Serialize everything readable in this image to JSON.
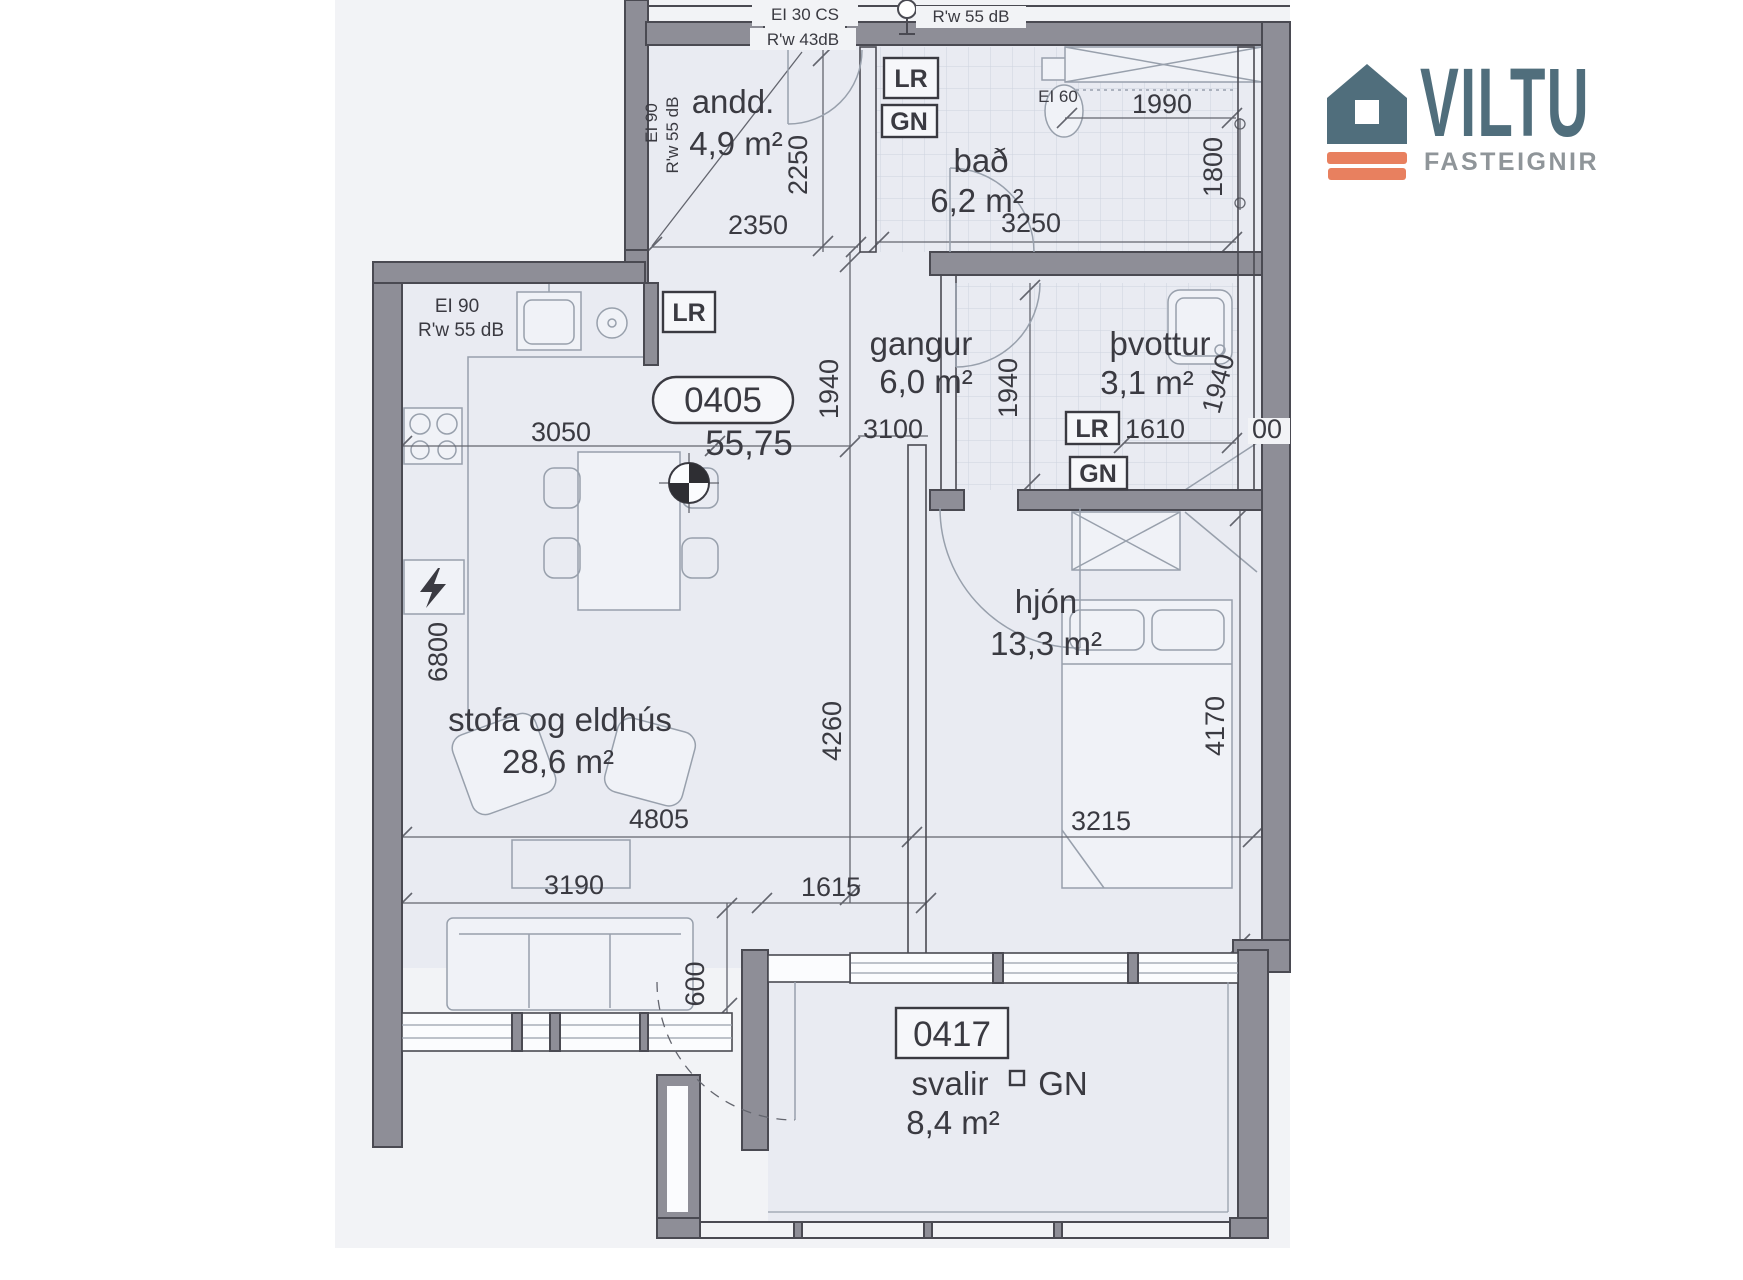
{
  "theme": {
    "ink": "#3a3a41",
    "wall": "#8e8e97",
    "wallstroke": "#4a4a52",
    "line": "#63656e",
    "furn": "#98a0ac",
    "paper": "#e9ebf2",
    "scan": "#f2f3f6",
    "tile": "#cdd3df",
    "slate": "#506e7c",
    "orange": "#e8805f",
    "graytag": "#8f9599"
  },
  "logo": {
    "brand": "VILTU",
    "tagline": "FASTEIGNIR"
  },
  "plan": {
    "unit": {
      "number": "0405",
      "total_area": "55,75"
    },
    "balcony_unit": {
      "number": "0417"
    },
    "tags": {
      "lr": "LR",
      "gn": "GN"
    },
    "rooms": {
      "andd": {
        "name": "andd.",
        "area": "4,9 m²"
      },
      "bad": {
        "name": "bað",
        "area": "6,2 m²"
      },
      "gangur": {
        "name": "gangur",
        "area": "6,0 m²"
      },
      "thvottur": {
        "name": "þvottur",
        "area": "3,1 m²"
      },
      "hjon": {
        "name": "hjón",
        "area": "13,3 m²"
      },
      "stofa": {
        "name": "stofa og eldhús",
        "area": "28,6 m²"
      },
      "svalir": {
        "name": "svalir",
        "area": "8,4 m²"
      }
    },
    "fire_sound": {
      "top_cs": "EI 30 CS",
      "top_rw": "R'w 55 dB",
      "entry_rw": "R'w 43dB",
      "andd_ei": "EI 90",
      "andd_rw": "R'w 55 dB",
      "kitchen_ei": "EI 90",
      "kitchen_rw": "R'w 55 dB",
      "bath_ei": "EI 60"
    },
    "dimensions": {
      "andd_w": "2350",
      "andd_h": "2250",
      "bath_w": "3250",
      "bath_top": "1990",
      "bath_depth": "1800",
      "kitchen_w": "3050",
      "hall_w": "3100",
      "hall_h": "1940",
      "laundry_h": "1940",
      "laundry_right": "1940",
      "laundry_fix": "1610",
      "laundry_cut": "00",
      "living_h": "4260",
      "living_len": "6800",
      "living_w": "4805",
      "sofa_w": "3190",
      "mid_w": "1615",
      "balcony_off": "600",
      "bed_w": "3215",
      "bed_h": "4170"
    }
  }
}
